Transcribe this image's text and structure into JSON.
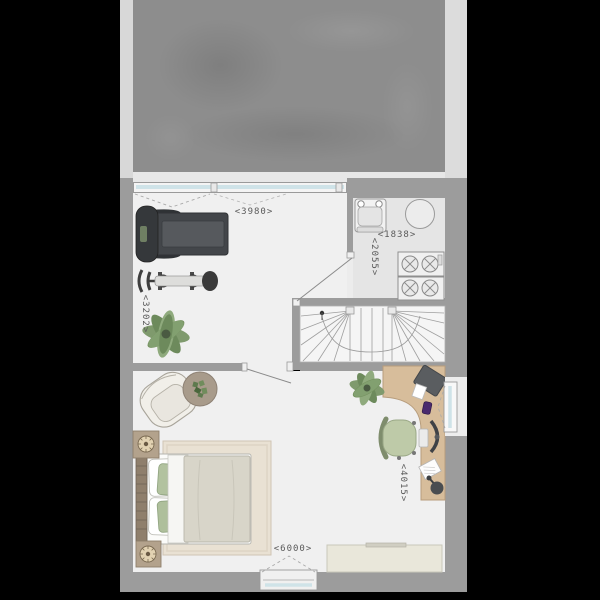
{
  "plan": {
    "kind": "floor-plan",
    "dimension_labels": {
      "gym_width": "<3980>",
      "gym_depth": "<3202>",
      "laundry_width": "<1838>",
      "laundry_depth": "<2055>",
      "bedroom_width": "<6000>",
      "bedroom_depth": "<4015>"
    },
    "palette": {
      "background": "#000000",
      "wall": "#9c9c9c",
      "terrace": "#8d8d8d",
      "floor": "#f0f0f0",
      "laundry_floor": "#e5e5e5",
      "glass": "#cfe3e8",
      "desk_wood": "#d7bd9b",
      "plant_green": "#7f9a6d",
      "textile_green": "#b2c29f",
      "duvet": "#d8d5c9",
      "rug": "#e9e1d3",
      "nightstand_wood": "#b3a28c",
      "equipment_dark": "#43464a",
      "annotation_text": "#5a5a5a"
    }
  }
}
